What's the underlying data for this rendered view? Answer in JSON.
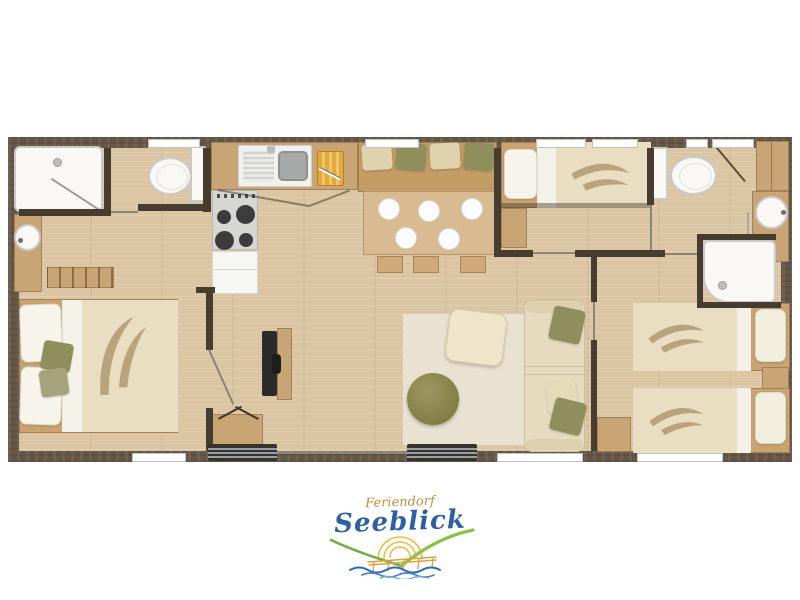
{
  "meta": {
    "title": "Holiday home floor plan"
  },
  "logo": {
    "line1": "Feriendorf",
    "line2": "Seeblick",
    "line1_color": "#c08f3c",
    "line2_color": "#2e5fa3",
    "graphic": {
      "hill_color": "#6fae43",
      "sun_color": "#f0bb45",
      "pier_color": "#d9a43c",
      "wave_color": "#2f6cb5"
    }
  },
  "palette": {
    "wall_outer": "#655646",
    "wall_inner": "#463c30",
    "floor": "#dcc5a2",
    "cabinet_wood": "#c9a474",
    "table_wood": "#d8bb90",
    "fabric_cream": "#e9ddc2",
    "fabric_olive": "#8f8f5e",
    "fixture_white": "#f9f8f5"
  },
  "rooms": [
    {
      "name": "bathroom-1",
      "fixtures": [
        "shower",
        "washbasin",
        "vanity-cabinet"
      ]
    },
    {
      "name": "wc",
      "fixtures": [
        "toilet"
      ]
    },
    {
      "name": "kitchen",
      "fixtures": [
        "sink-unit",
        "hob-4-burners",
        "cutting-board",
        "fridge",
        "worktop"
      ]
    },
    {
      "name": "dining-area",
      "fixtures": [
        "corner-bench",
        "4-cushions",
        "dining-table",
        "5-plates",
        "3-stools"
      ]
    },
    {
      "name": "living-room",
      "fixtures": [
        "tv",
        "tv-board",
        "sideboard",
        "rug",
        "square-pouf",
        "round-pouf",
        "sofa",
        "3-sofa-cushions"
      ]
    },
    {
      "name": "master-bedroom",
      "fixtures": [
        "double-bed",
        "2-pillows",
        "2-accent-cushions",
        "open-shelf"
      ]
    },
    {
      "name": "single-bedroom",
      "fixtures": [
        "single-bed",
        "pillow",
        "nightstand"
      ]
    },
    {
      "name": "twin-bedroom",
      "fixtures": [
        "2-single-beds",
        "2-pillows",
        "nightstand",
        "cabinet"
      ]
    },
    {
      "name": "bathroom-2",
      "fixtures": [
        "toilet",
        "washbasin",
        "shower",
        "corner-cabinet"
      ]
    }
  ]
}
